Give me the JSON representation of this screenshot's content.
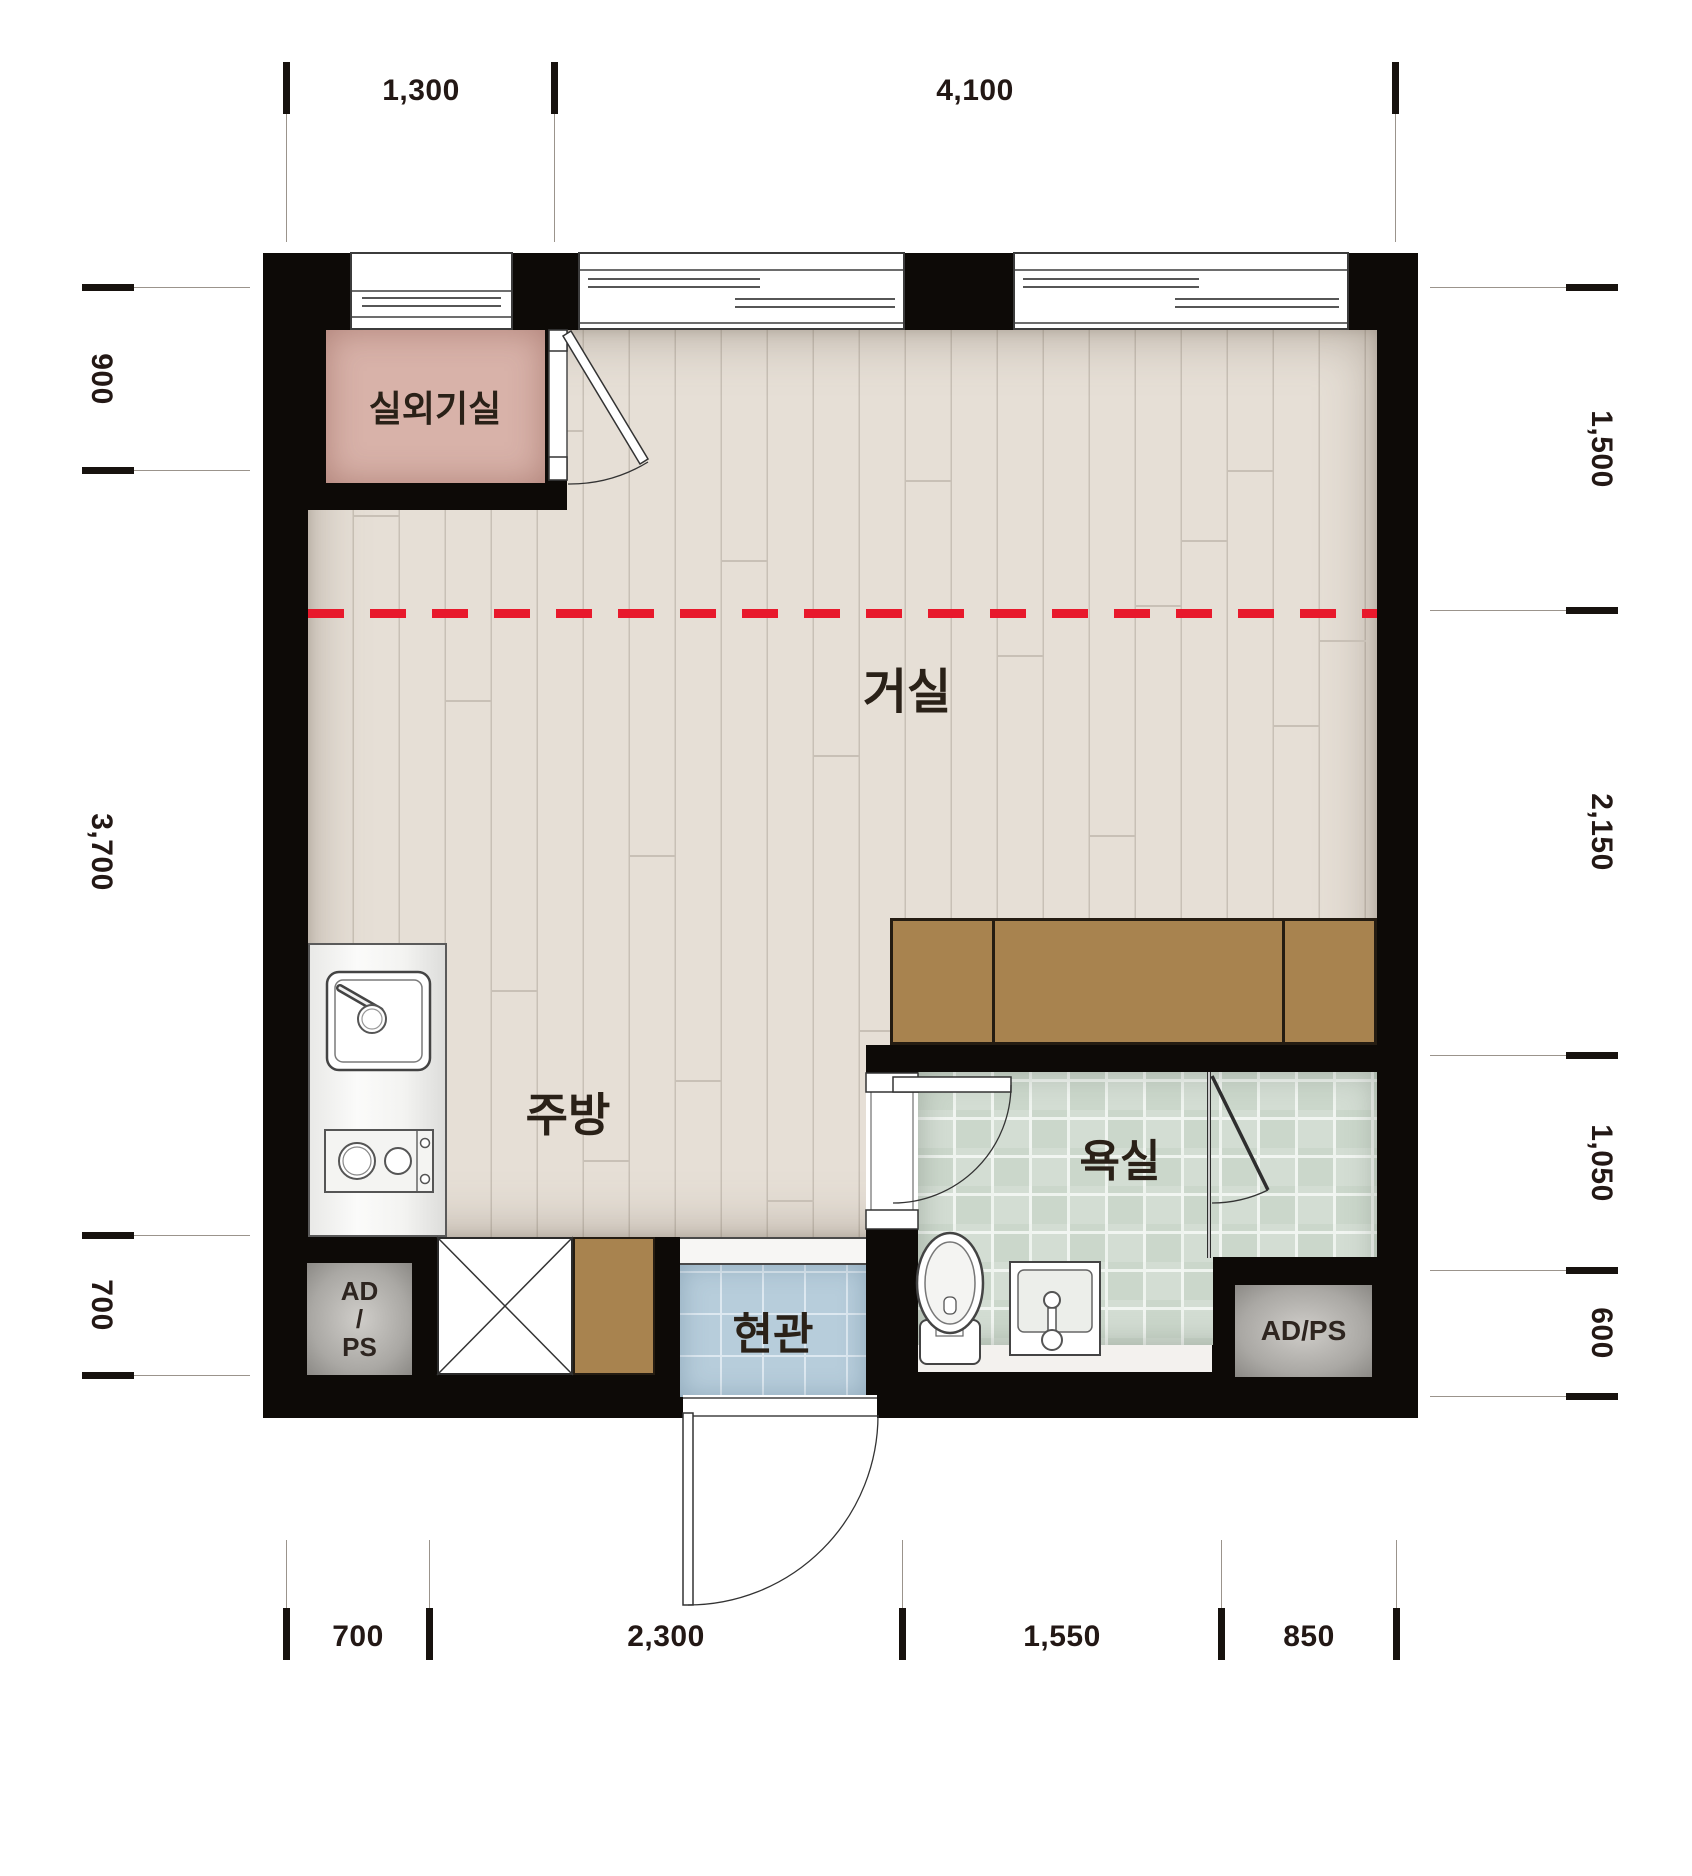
{
  "rooms": {
    "outdoor_unit": "실외기실",
    "living": "거실",
    "kitchen": "주방",
    "bathroom": "욕실",
    "entrance": "현관",
    "adps_left": {
      "l1": "AD",
      "l2": "/",
      "l3": "PS"
    },
    "adps_right": "AD/PS"
  },
  "dims": {
    "top": [
      "1,300",
      "4,100"
    ],
    "bottom": [
      "700",
      "2,300",
      "1,550",
      "850"
    ],
    "left": [
      "900",
      "3,700",
      "700"
    ],
    "right": [
      "1,500",
      "2,150",
      "1,050",
      "600"
    ]
  },
  "colors": {
    "wall": "#0d0a07",
    "wood_floor": "#e6dfd6",
    "outdoor_unit_pink": "#d8b2a9",
    "bath_tile": "#cbd7cb",
    "entry_tile": "#b7cddb",
    "cabinet_brown": "#a8834f",
    "section_line_red": "#e8192c",
    "dimension_text": "#231815"
  }
}
